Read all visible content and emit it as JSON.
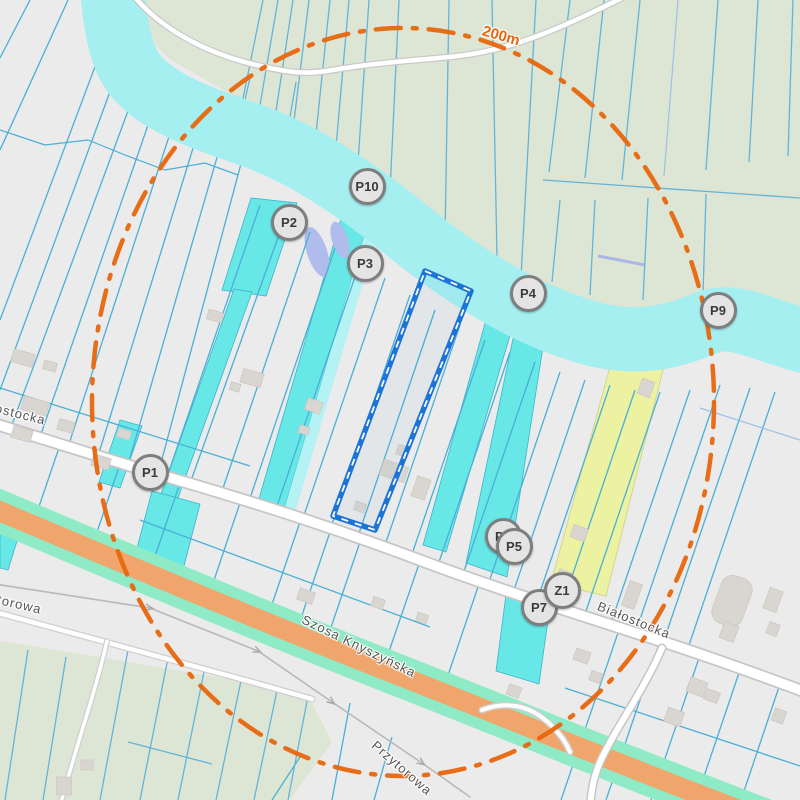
{
  "map": {
    "type": "cadastral-parcel-map",
    "scale_ring": {
      "label": "200m",
      "x": 501,
      "y": 36,
      "rotation": 16
    },
    "markers": [
      {
        "label": "P10",
        "x": 367,
        "y": 186
      },
      {
        "label": "P2",
        "x": 289,
        "y": 222
      },
      {
        "label": "P3",
        "x": 365,
        "y": 263
      },
      {
        "label": "P4",
        "x": 528,
        "y": 293
      },
      {
        "label": "P9",
        "x": 718,
        "y": 310
      },
      {
        "label": "P1",
        "x": 150,
        "y": 472
      },
      {
        "label": "P6",
        "x": 503,
        "y": 536
      },
      {
        "label": "P5",
        "x": 514,
        "y": 546
      },
      {
        "label": "P7",
        "x": 539,
        "y": 607
      },
      {
        "label": "Z1",
        "x": 562,
        "y": 590
      }
    ],
    "street_labels": [
      {
        "name": "Białostocka",
        "x": 8,
        "y": 411,
        "rotation": 14
      },
      {
        "name": "Szosa Knyszyńska",
        "x": 359,
        "y": 646,
        "rotation": 26
      },
      {
        "name": "Białostocka",
        "x": 634,
        "y": 620,
        "rotation": 22
      },
      {
        "name": "Przytorowa",
        "x": 402,
        "y": 768,
        "rotation": 41
      },
      {
        "name": "Przytorowa",
        "x": 5,
        "y": 601,
        "rotation": 13
      }
    ],
    "colors": {
      "background": "#ebebeb",
      "field_green": "#dde6d4",
      "water_main": "#55dee9",
      "water_buffer": "#a6eff1",
      "water_centerline": "#b5abe8",
      "water_upstream_lavender": "#a9b4e9",
      "parcel_line": "#4aafd6",
      "cyan_parcel": "#68e7e7",
      "yellow_parcel": "#edf2a2",
      "wetland_lavender": "#b0bcec",
      "selection_blue": "#1b74d6",
      "buffer_ring_orange": "#e8660d",
      "road_fill": "#ffffff",
      "road_casing": "#c6c6c6",
      "highway_orange": "#f0a56d",
      "highway_edge_mint": "#8feac6",
      "building": "#d9d5d0",
      "marker_fill": "#e4e4e4",
      "marker_border": "#7e7e7e"
    }
  }
}
